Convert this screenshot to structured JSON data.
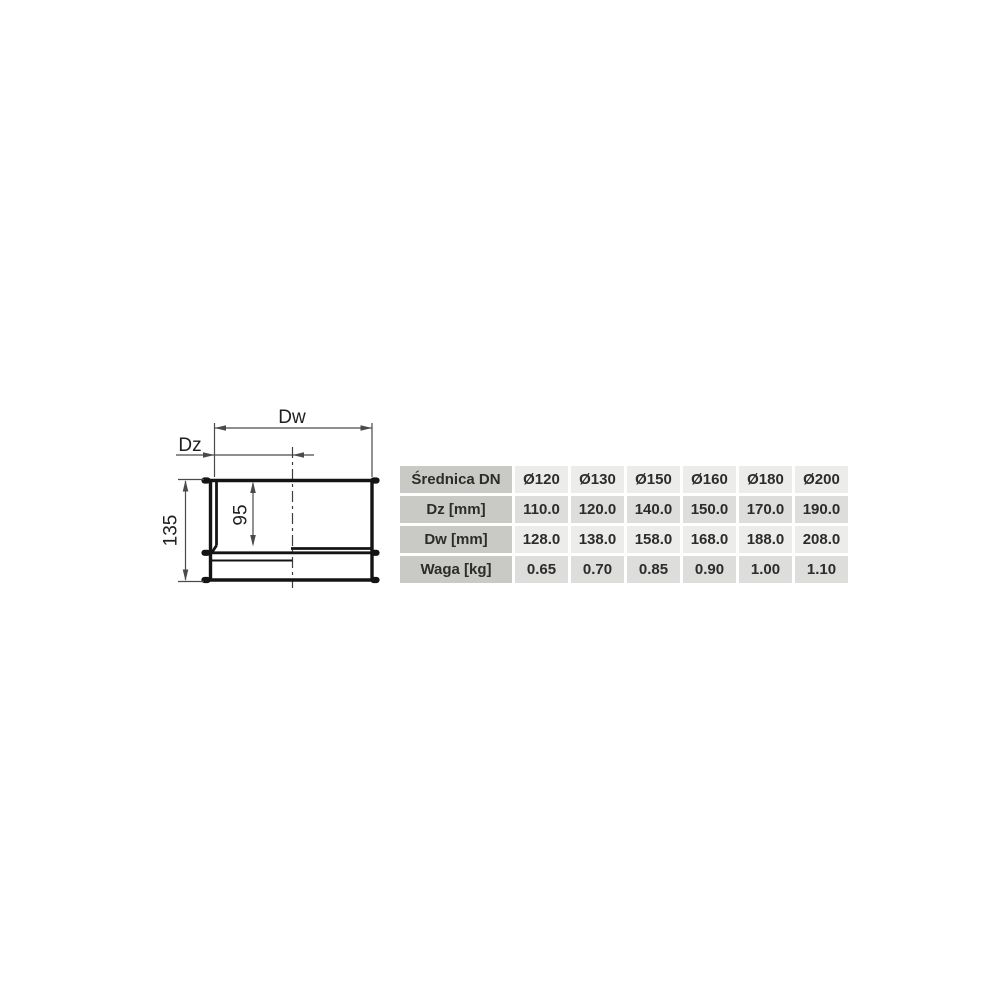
{
  "drawing": {
    "labels": {
      "dw": "Dw",
      "dz": "Dz",
      "inner_height": "95",
      "total_height": "135"
    }
  },
  "table": {
    "corner_label": "Średnica DN",
    "columns": [
      "Ø120",
      "Ø130",
      "Ø150",
      "Ø160",
      "Ø180",
      "Ø200"
    ],
    "rows": [
      {
        "label": "Dz [mm]",
        "values": [
          "110.0",
          "120.0",
          "140.0",
          "150.0",
          "170.0",
          "190.0"
        ]
      },
      {
        "label": "Dw [mm]",
        "values": [
          "128.0",
          "138.0",
          "158.0",
          "168.0",
          "188.0",
          "208.0"
        ]
      },
      {
        "label": "Waga [kg]",
        "values": [
          "0.65",
          "0.70",
          "0.85",
          "0.90",
          "1.00",
          "1.10"
        ]
      }
    ]
  },
  "colors": {
    "page-bg": "#ffffff",
    "header-col-bg": "#c9c9c5",
    "row-light-bg": "#ececea",
    "row-dark-bg": "#dddddb",
    "table-text": "#2c2c2a",
    "line-color": "#141414",
    "dim-color": "#4a4a4a"
  }
}
